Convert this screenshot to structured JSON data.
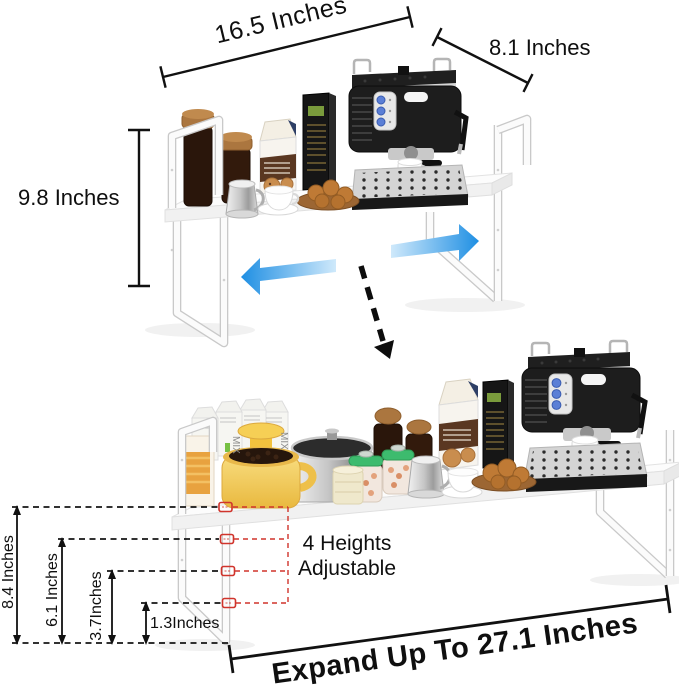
{
  "diagram": {
    "background": "#ffffff",
    "labels": {
      "top_width": "16.5 Inches",
      "depth": "8.1 Inches",
      "top_height": "9.8 Inches",
      "adjust_line1": "4 Heights",
      "adjust_line2": "Adjustable",
      "leg_height_large": "8.4 Inches",
      "leg_height_medium": "6.1 Inches",
      "leg_height_small": "3.7Inches",
      "leg_height_min": "1.3Inches",
      "expanded_width": "Expand Up To 27.1 Inches"
    },
    "product_text": {
      "mix_box": "MIX"
    },
    "colors": {
      "annotation_black": "#111111",
      "adjust_red": "#d0342c",
      "expand_arrow_blue": "#1f8fe3",
      "expand_arrow_blue_light": "#cfe9fb",
      "shelf_white": "#fbfbfb",
      "machine_black": "#1d1d1d",
      "machine_silver": "#d4d4d4",
      "button_blue": "#5b7fd6",
      "wood_lid_brown": "#ab763f",
      "cookie_brown": "#bf7a35",
      "pot_yellow": "#f2c94c",
      "jar_lid_green": "#3dbb6e"
    }
  }
}
